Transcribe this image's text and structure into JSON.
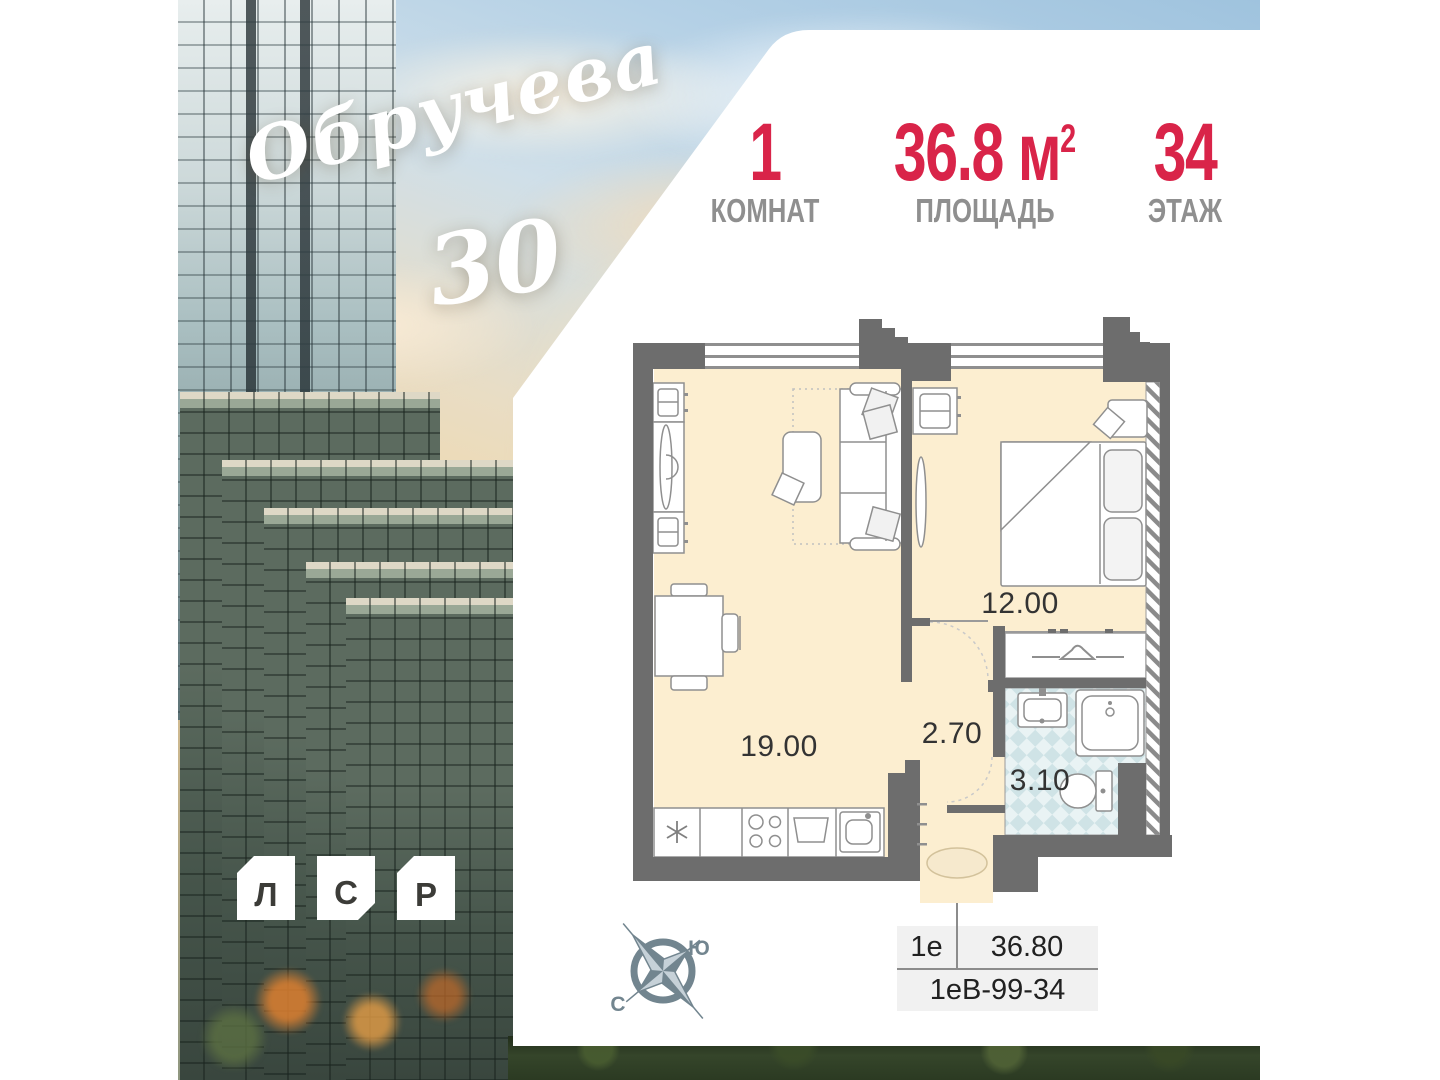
{
  "header": {
    "stats": [
      {
        "value": "1",
        "label": "КОМНАТ"
      },
      {
        "value": "36.8",
        "unit": "м",
        "unit_sup": "2",
        "label": "ПЛОЩАДЬ"
      },
      {
        "value": "34",
        "label": "ЭТАЖ"
      }
    ]
  },
  "branding": {
    "project_name": "Обручева",
    "project_number": "30",
    "developer_letters": [
      "Л",
      "С",
      "Р"
    ]
  },
  "floor_plan": {
    "rooms": [
      {
        "name": "living-kitchen",
        "area": "19.00"
      },
      {
        "name": "bedroom",
        "area": "12.00"
      },
      {
        "name": "hallway",
        "area": "2.70"
      },
      {
        "name": "bathroom",
        "area": "3.10"
      }
    ]
  },
  "compass": {
    "south": "Ю",
    "north": "С"
  },
  "info_table": {
    "layout_type": "1е",
    "total_area": "36.80",
    "unit_code": "1еВ-99-34"
  },
  "colors": {
    "accent_red": "#d92449",
    "label_gray": "#8f8f8f",
    "wall_gray": "#6d6d6d",
    "floor_cream": "#fceed0",
    "tile_blue": "#d9eaec"
  }
}
